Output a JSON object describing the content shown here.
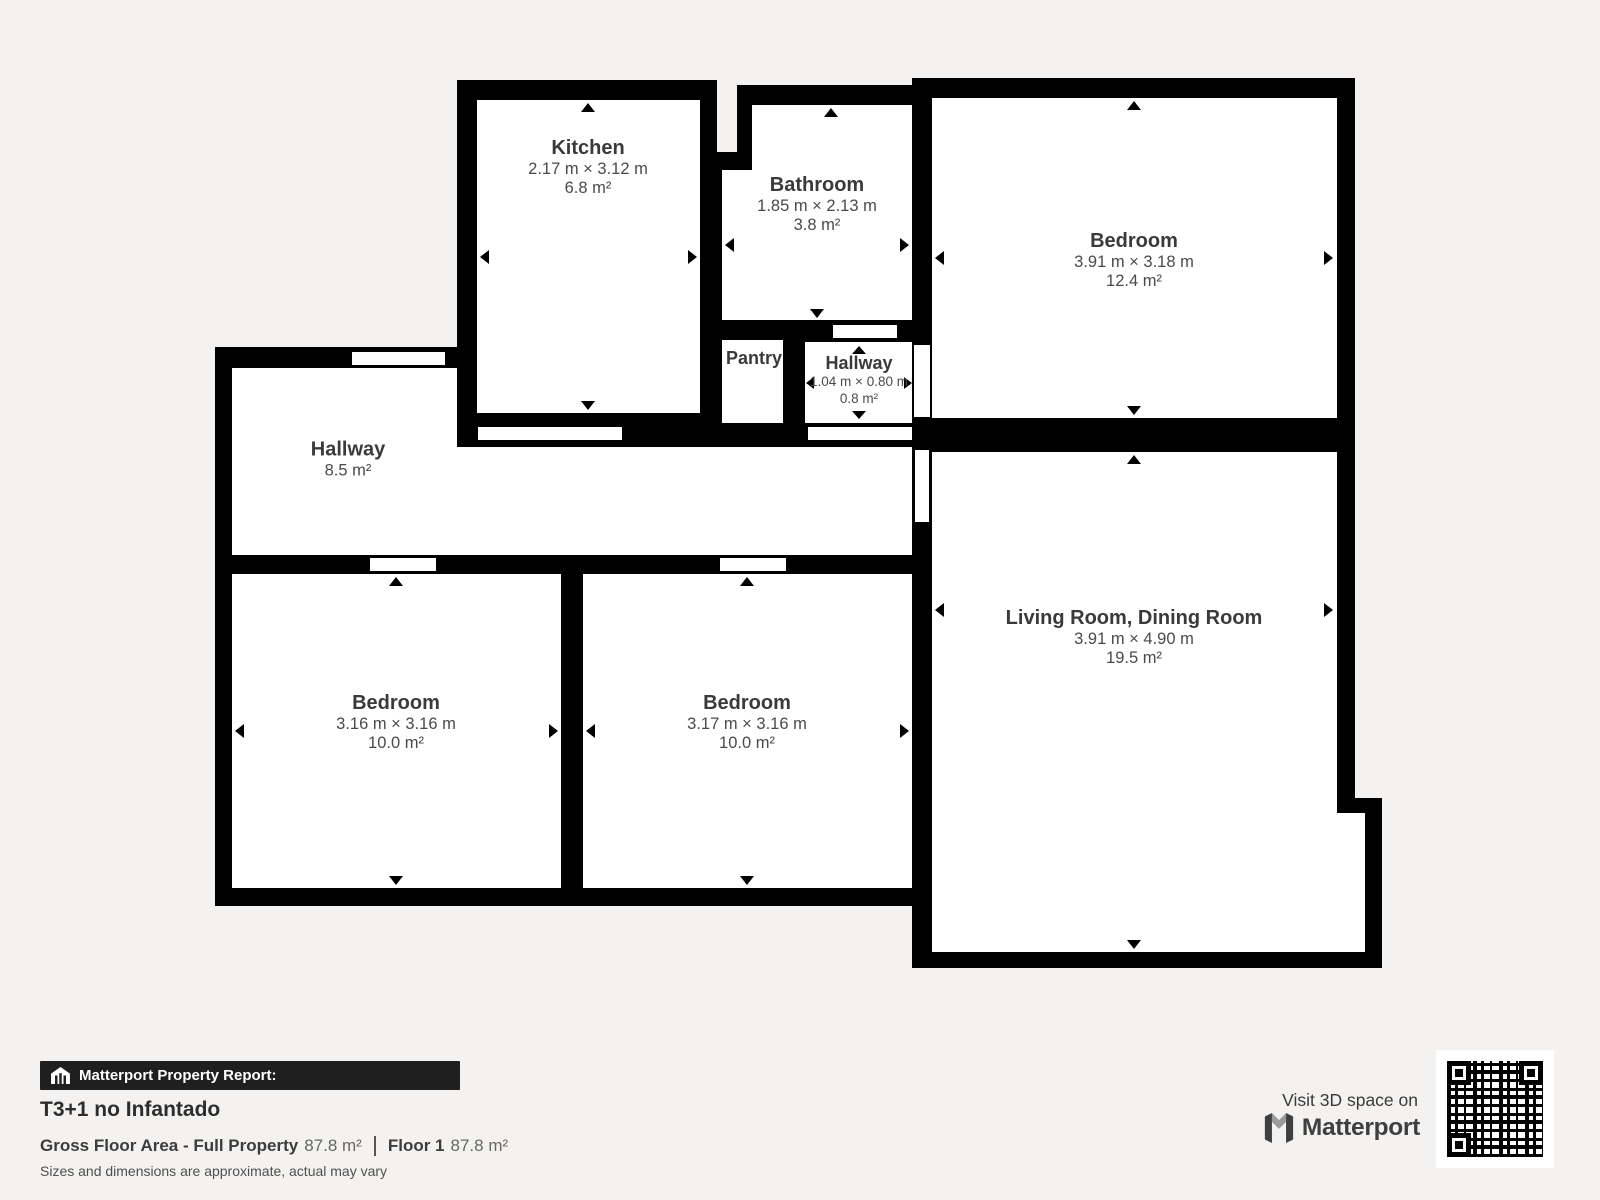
{
  "plan": {
    "rooms": [
      {
        "id": "kitchen",
        "name": "Kitchen",
        "dims": "2.17 m × 3.12 m",
        "area": "6.8 m²"
      },
      {
        "id": "bathroom",
        "name": "Bathroom",
        "dims": "1.85 m × 2.13 m",
        "area": "3.8 m²"
      },
      {
        "id": "bedroom-top-right",
        "name": "Bedroom",
        "dims": "3.91 m × 3.18 m",
        "area": "12.4 m²"
      },
      {
        "id": "pantry",
        "name": "Pantry",
        "dims": "",
        "area": ""
      },
      {
        "id": "hallway-small",
        "name": "Hallway",
        "dims": "1.04 m × 0.80 m",
        "area": "0.8 m²"
      },
      {
        "id": "hallway-main",
        "name": "Hallway",
        "dims": "",
        "area": "8.5 m²"
      },
      {
        "id": "bedroom-bottom-left",
        "name": "Bedroom",
        "dims": "3.16 m × 3.16 m",
        "area": "10.0 m²"
      },
      {
        "id": "bedroom-bottom-middle",
        "name": "Bedroom",
        "dims": "3.17 m × 3.16 m",
        "area": "10.0 m²"
      },
      {
        "id": "living-dining",
        "name": "Living Room, Dining Room",
        "dims": "3.91 m × 4.90 m",
        "area": "19.5 m²"
      }
    ]
  },
  "footer": {
    "report_label": "Matterport Property Report:",
    "property_name": "T3+1 no Infantado",
    "gross_floor_label": "Gross Floor Area - Full Property",
    "gross_floor_value": "87.8 m²",
    "floor_label": "Floor 1",
    "floor_value": "87.8 m²",
    "disclaimer": "Sizes and dimensions are approximate, actual may vary"
  },
  "promo": {
    "visit_text": "Visit 3D space on",
    "brand": "Matterport"
  },
  "colors": {
    "background": "#f3f2f0",
    "walls": "#000000",
    "room_fill": "#ffffff",
    "label_text": "#3a3a3a",
    "footer_bar": "#1f1f1f"
  }
}
